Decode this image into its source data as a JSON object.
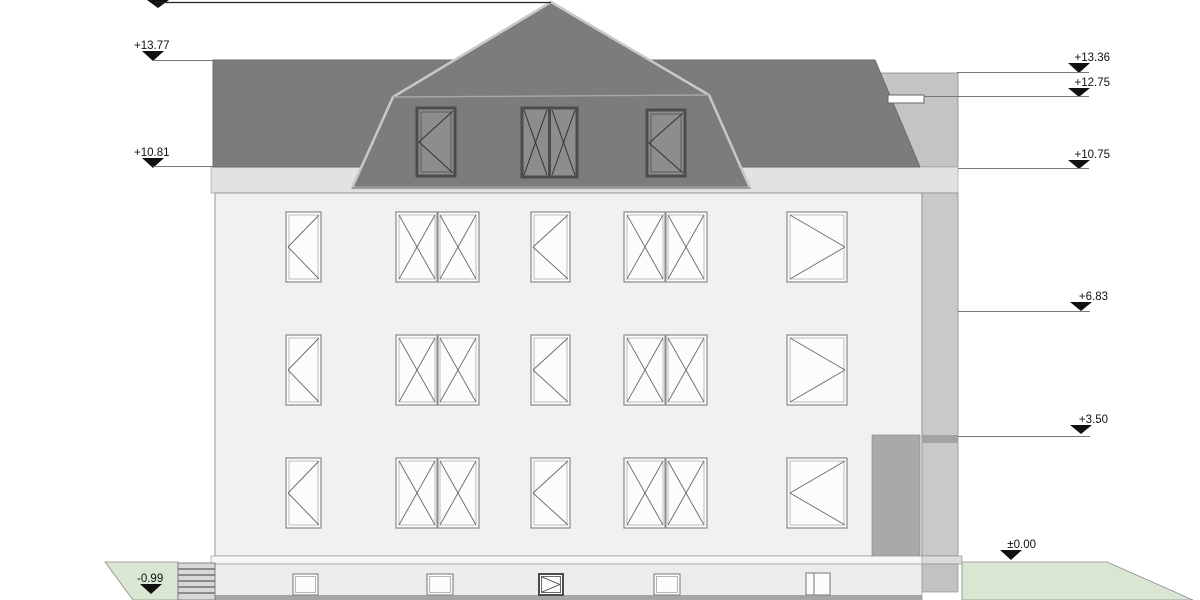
{
  "drawing": {
    "kind": "building-elevation",
    "annotations": {
      "left": [
        {
          "label": "+13.77"
        },
        {
          "label": "+10.81"
        },
        {
          "label": "-0.99"
        }
      ],
      "right": [
        {
          "label": "+13.36"
        },
        {
          "label": "+12.75"
        },
        {
          "label": "+10.75"
        },
        {
          "label": "+6.83"
        },
        {
          "label": "+3.50"
        },
        {
          "label": "±0.00"
        }
      ]
    },
    "colors": {
      "roof": "#7c7c7c",
      "roof_edge_highlight": "#c8c8c8",
      "facade": "#f1f1f1",
      "cornice": "#e2e2e2",
      "annex_wall": "#c9c9c9",
      "slab_strip": "#a2a2a2",
      "loggia_block": "#a9a9a9",
      "plinth": "#ececec",
      "base_shadow": "#a5a5a5",
      "ground_green": "#d9e6d2",
      "window_glass": "#fcfcfc",
      "window_frame": "#909090",
      "dormer_glass": "#8d8d8d",
      "dormer_frame": "#4c4c4c",
      "marker": "#111111"
    }
  }
}
